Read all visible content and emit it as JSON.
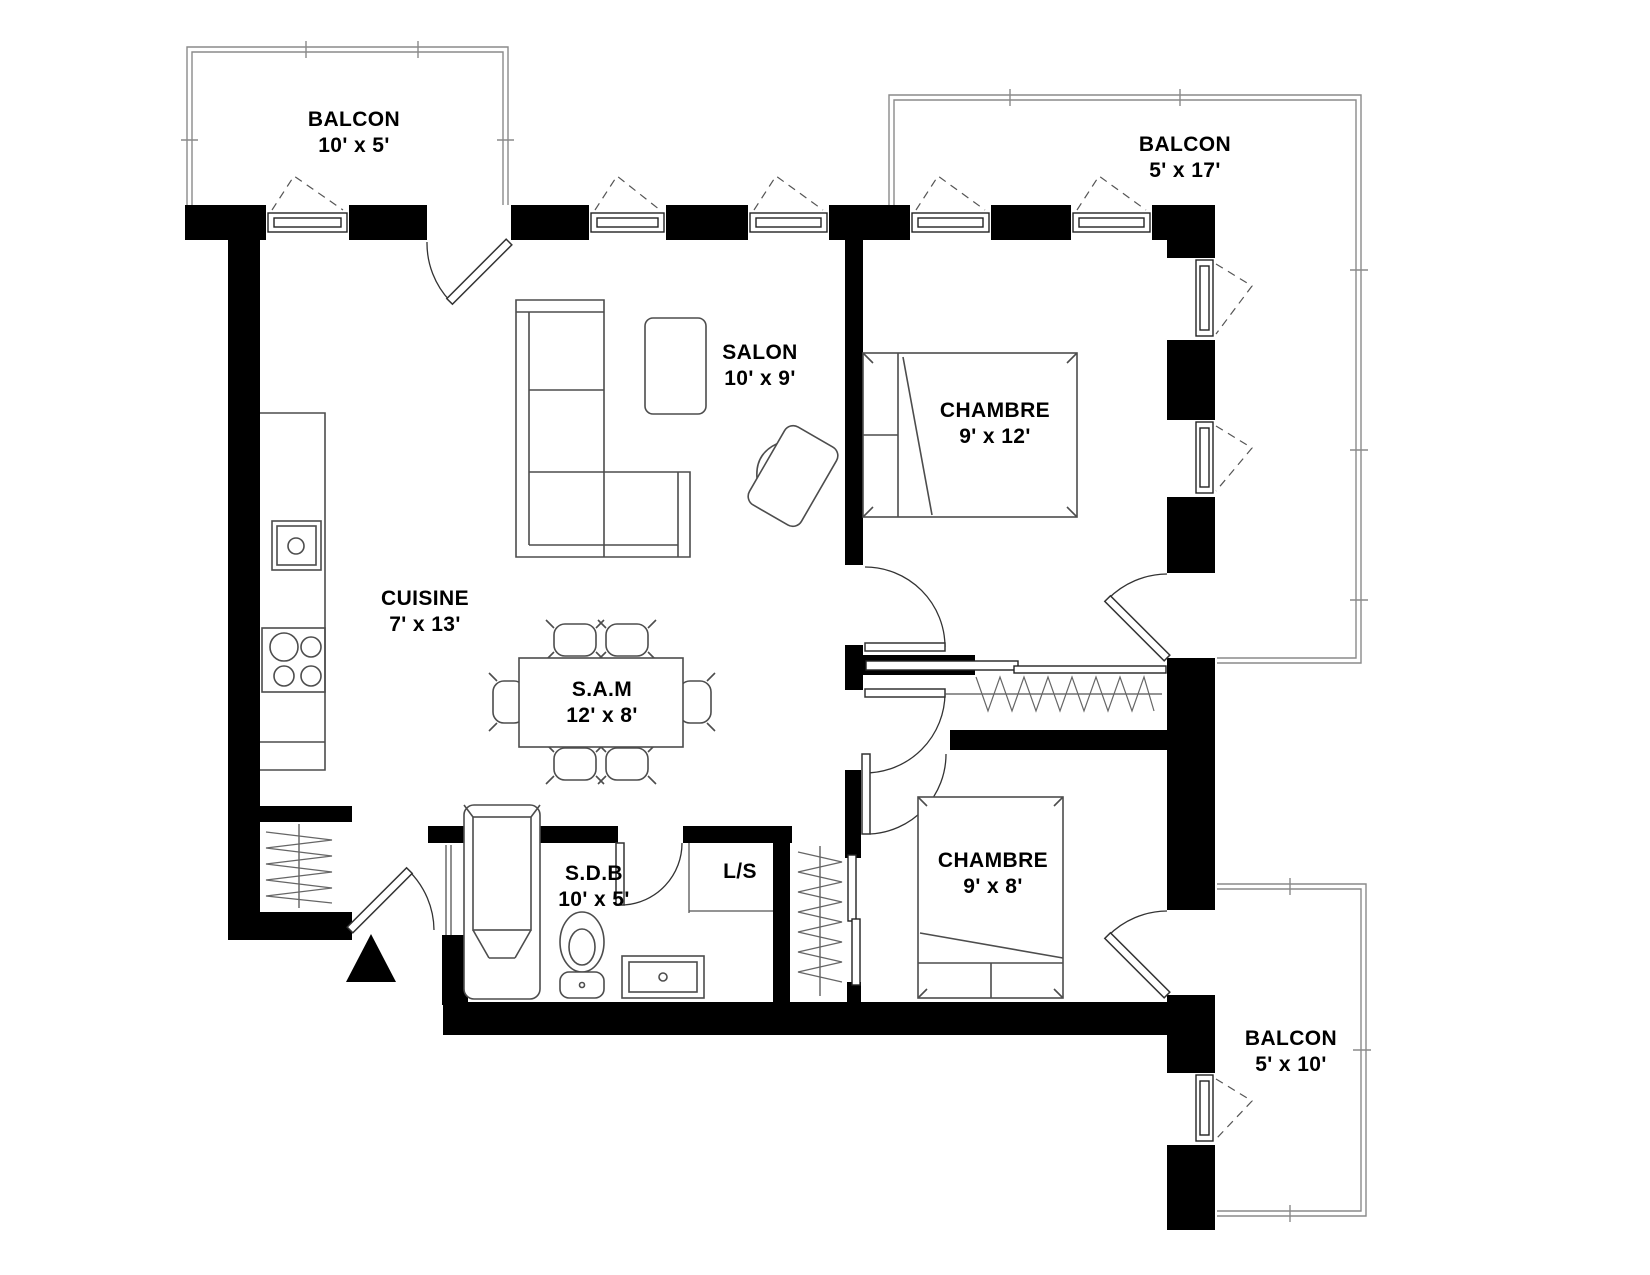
{
  "title": "Plan d'appartement",
  "colors": {
    "wall": "#000000",
    "furniture_line": "#4d4d4d",
    "railing": "#8a8a8a",
    "label": "#000000",
    "background": "#ffffff"
  },
  "rooms": {
    "balcon_tl": {
      "name": "BALCON",
      "dims": "10' x 5'"
    },
    "balcon_tr": {
      "name": "BALCON",
      "dims": "5' x 17'"
    },
    "salon": {
      "name": "SALON",
      "dims": "10' x 9'"
    },
    "chambre1": {
      "name": "CHAMBRE",
      "dims": "9' x 12'"
    },
    "cuisine": {
      "name": "CUISINE",
      "dims": "7' x 13'"
    },
    "sam": {
      "name": "S.A.M",
      "dims": "12' x 8'"
    },
    "sdb": {
      "name": "S.D.B",
      "dims": "10' x 5'"
    },
    "ls": {
      "name": "L/S",
      "dims": ""
    },
    "chambre2": {
      "name": "CHAMBRE",
      "dims": "9' x 8'"
    },
    "balcon_br": {
      "name": "BALCON",
      "dims": "5' x 10'"
    }
  }
}
